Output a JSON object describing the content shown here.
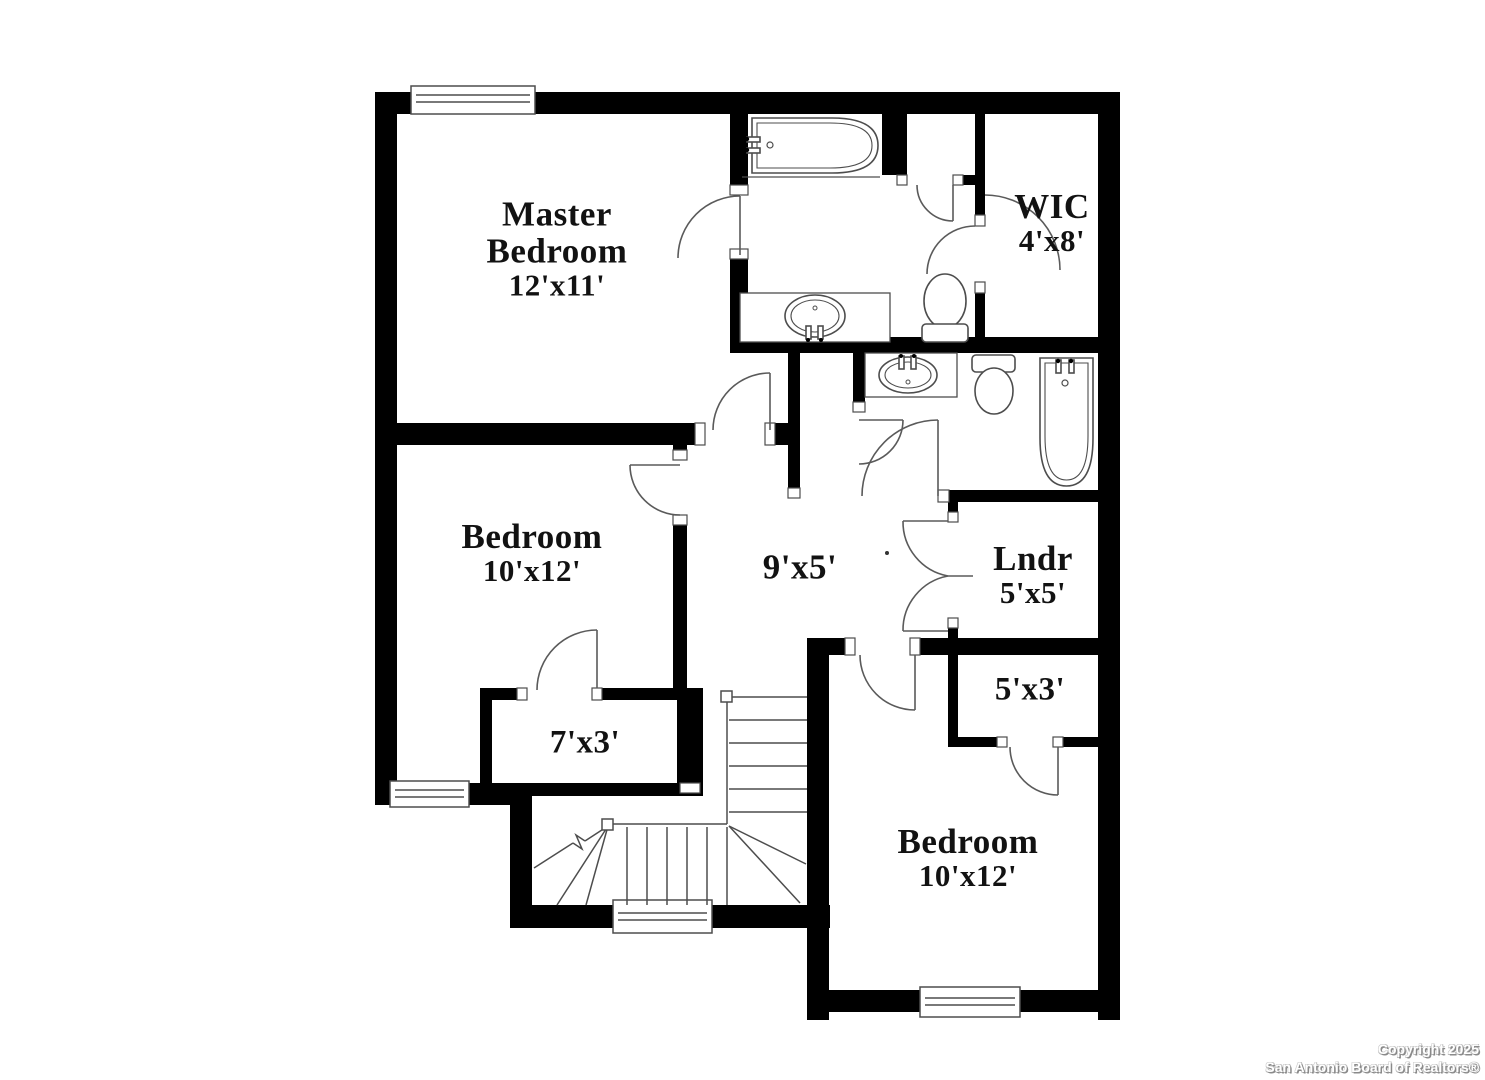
{
  "rooms": {
    "master_bedroom": {
      "label_line1": "Master",
      "label_line2": "Bedroom",
      "dimensions": "12'x11'"
    },
    "wic": {
      "label_line1": "WIC",
      "dimensions": "4'x8'"
    },
    "bedroom_left": {
      "label_line1": "Bedroom",
      "dimensions": "10'x12'"
    },
    "hallway": {
      "dimensions": "9'x5'"
    },
    "laundry": {
      "label_line1": "Lndr",
      "dimensions": "5'x5'"
    },
    "closet_5x3": {
      "dimensions": "5'x3'"
    },
    "closet_7x3": {
      "dimensions": "7'x3'"
    },
    "bedroom_right": {
      "label_line1": "Bedroom",
      "dimensions": "10'x12'"
    }
  },
  "footer": {
    "copyright": "Copyright 2025",
    "attribution": "San Antonio Board of Realtors®"
  },
  "colors": {
    "background": "#ffffff",
    "wall": "#000000",
    "fixture_line": "#4d4d4d",
    "label_text": "#121212",
    "watermark_text": "#ffffff",
    "watermark_shadow": "#8a8a8a"
  }
}
